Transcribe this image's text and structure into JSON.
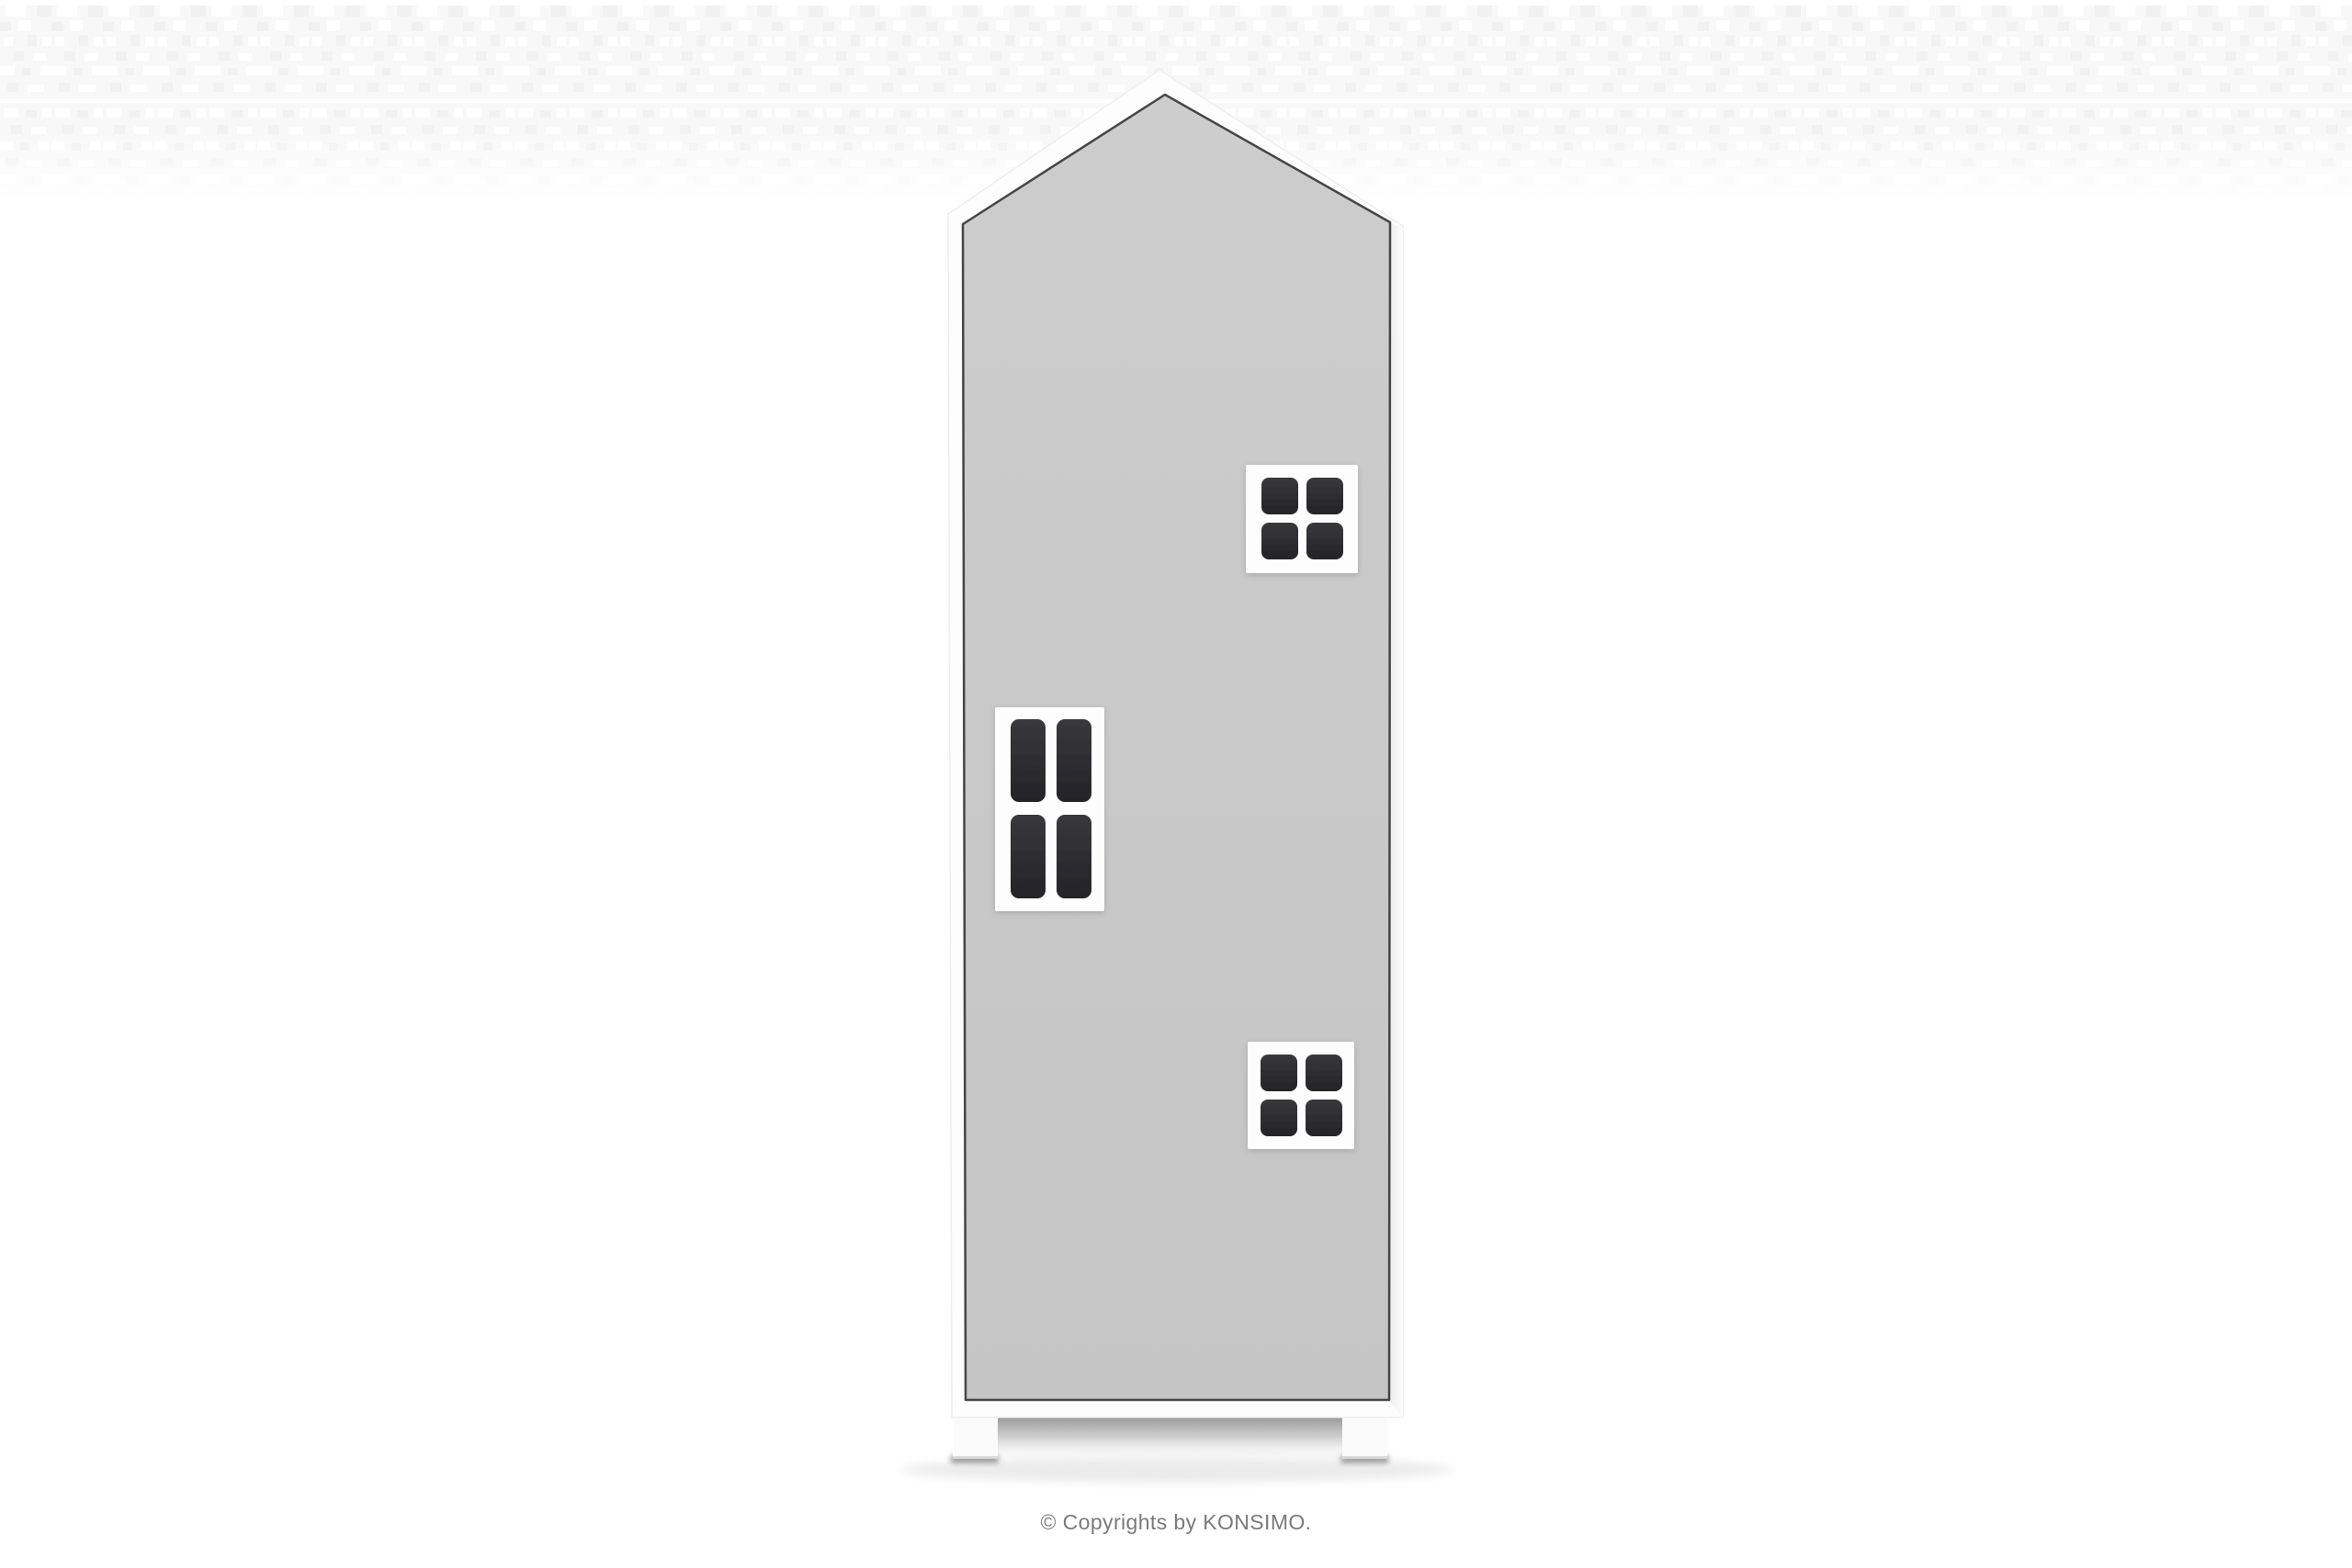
{
  "footer": {
    "copyright": "© Copyrights by KONSIMO.",
    "text_color": "#7a7a7a"
  },
  "product": {
    "colors": {
      "front_light": "#cdcdcd",
      "front": "#c5c5c5",
      "frame": "#fdfdfd",
      "pane_light": "#38383c",
      "pane": "#242427",
      "gap_line": "#454545",
      "shadow": "#8a8a8a"
    }
  }
}
